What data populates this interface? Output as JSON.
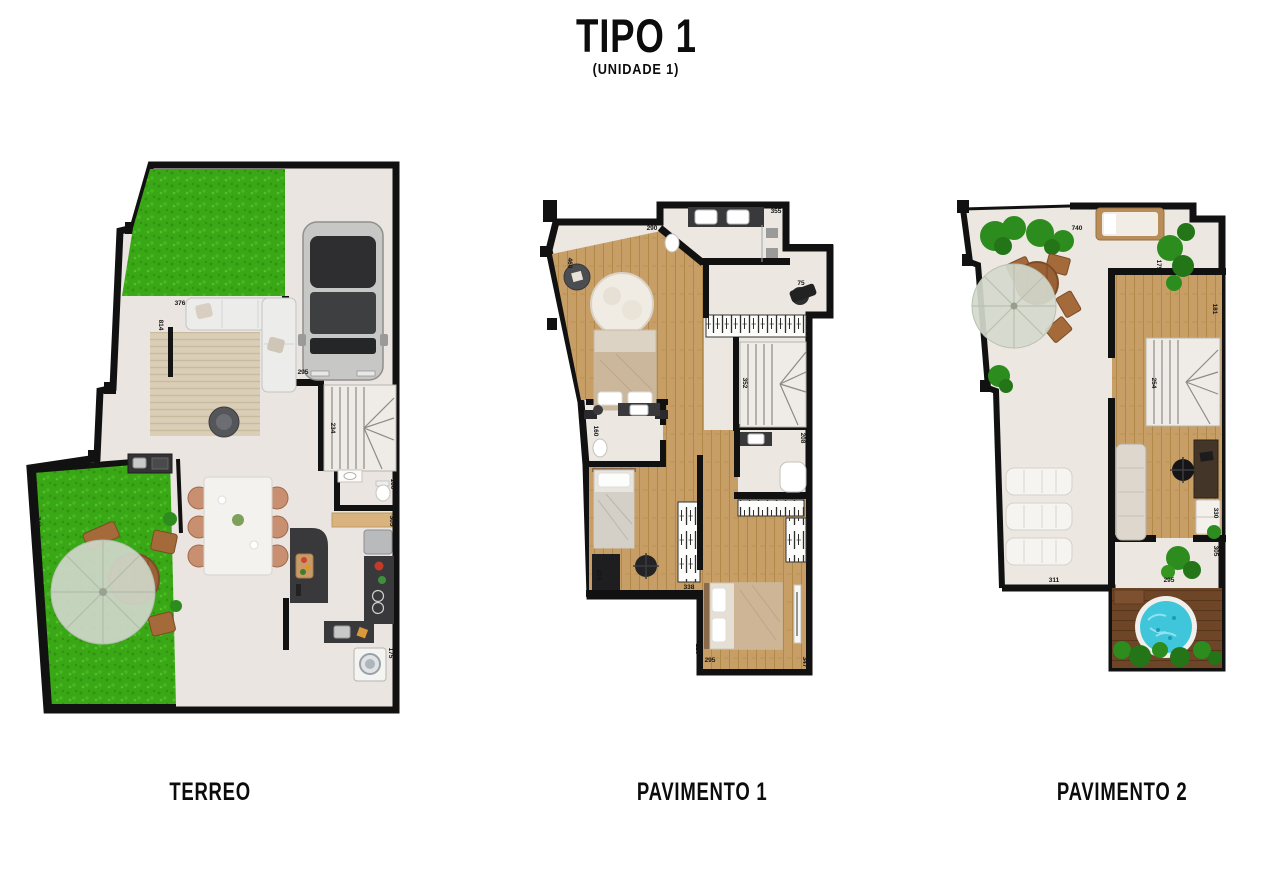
{
  "title": "TIPO 1",
  "subtitle": "(UNIDADE 1)",
  "floors": [
    {
      "id": "terreo",
      "label": "TERREO",
      "dims": [
        {
          "t": "376",
          "x": 180,
          "y": 305
        },
        {
          "t": "814",
          "x": 159,
          "y": 325,
          "r": 90
        },
        {
          "t": "295",
          "x": 303,
          "y": 374
        },
        {
          "t": "234",
          "x": 331,
          "y": 428,
          "r": 90
        },
        {
          "t": "160",
          "x": 391,
          "y": 484,
          "r": 90
        },
        {
          "t": "305",
          "x": 390,
          "y": 521,
          "r": 90
        },
        {
          "t": "175",
          "x": 389,
          "y": 653,
          "r": 90
        },
        {
          "t": "456",
          "x": 94,
          "y": 468
        },
        {
          "t": "740",
          "x": 36,
          "y": 522,
          "r": 90
        }
      ]
    },
    {
      "id": "pav1",
      "label": "PAVIMENTO 1",
      "dims": [
        {
          "t": "290",
          "x": 652,
          "y": 230
        },
        {
          "t": "355",
          "x": 776,
          "y": 213
        },
        {
          "t": "75",
          "x": 801,
          "y": 285
        },
        {
          "t": "460",
          "x": 568,
          "y": 263,
          "r": 90
        },
        {
          "t": "171",
          "x": 806,
          "y": 330,
          "r": 90
        },
        {
          "t": "352",
          "x": 743,
          "y": 383,
          "r": 90
        },
        {
          "t": "160",
          "x": 594,
          "y": 431,
          "r": 90
        },
        {
          "t": "208",
          "x": 801,
          "y": 438,
          "r": 90
        },
        {
          "t": "424",
          "x": 597,
          "y": 575,
          "r": 90
        },
        {
          "t": "338",
          "x": 689,
          "y": 589
        },
        {
          "t": "228",
          "x": 696,
          "y": 649,
          "r": 90
        },
        {
          "t": "295",
          "x": 710,
          "y": 662
        },
        {
          "t": "347",
          "x": 803,
          "y": 662,
          "r": 90
        }
      ]
    },
    {
      "id": "pav2",
      "label": "PAVIMENTO 2",
      "dims": [
        {
          "t": "740",
          "x": 1077,
          "y": 230
        },
        {
          "t": "175",
          "x": 1157,
          "y": 265,
          "r": 90
        },
        {
          "t": "181",
          "x": 1213,
          "y": 309,
          "r": 90
        },
        {
          "t": "254",
          "x": 1152,
          "y": 383,
          "r": 90
        },
        {
          "t": "311",
          "x": 1054,
          "y": 582
        },
        {
          "t": "295",
          "x": 1169,
          "y": 582
        },
        {
          "t": "330",
          "x": 1214,
          "y": 513,
          "r": 90
        },
        {
          "t": "305",
          "x": 1214,
          "y": 551,
          "r": 90
        }
      ]
    }
  ],
  "colors": {
    "wall": "#111111",
    "tile": "#eae5e0",
    "wood": "#c9a36b",
    "grass": "#3aa716",
    "counter": "#39393b",
    "deck": "#6f4527",
    "water": "#3fc6da",
    "plant": "#2d8c1e"
  }
}
